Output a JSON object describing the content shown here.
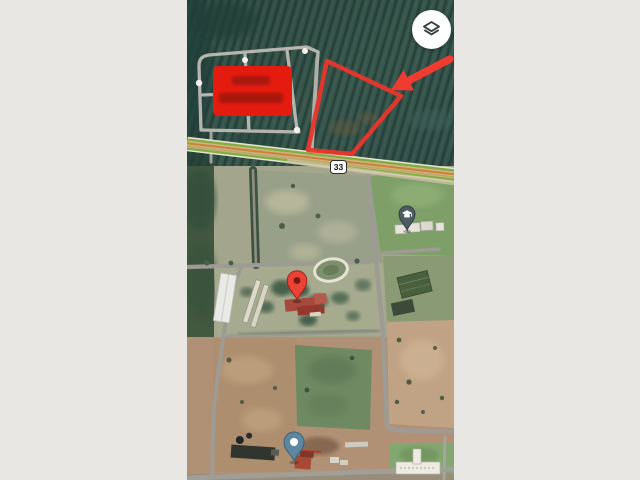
{
  "app": {
    "view": "satellite-map",
    "background_color": "#e9e7e3"
  },
  "map": {
    "route_shield_label": "33",
    "controls": {
      "layers_button_label": "Layers",
      "layers_icon": "layers-icon"
    },
    "overlays": {
      "highlight_rect_color": "#e41c10",
      "highlight_text_color": "#9c120b",
      "plot_outline_color": "#e8372c",
      "arrow_color": "#ef3b30"
    },
    "markers": [
      {
        "id": "destination-pin",
        "icon": "map-pin-icon",
        "color": "#e94336"
      },
      {
        "id": "school-pin",
        "icon": "graduation-cap-icon",
        "color": "#4d5b63"
      },
      {
        "id": "poi-pin",
        "icon": "dot-pin-icon",
        "color": "#5d87a1"
      }
    ],
    "colors": {
      "road_green": "#7fae41",
      "road_center": "#c98336",
      "highway_fill": "#d2b183",
      "field_dark": "#35544b"
    }
  }
}
